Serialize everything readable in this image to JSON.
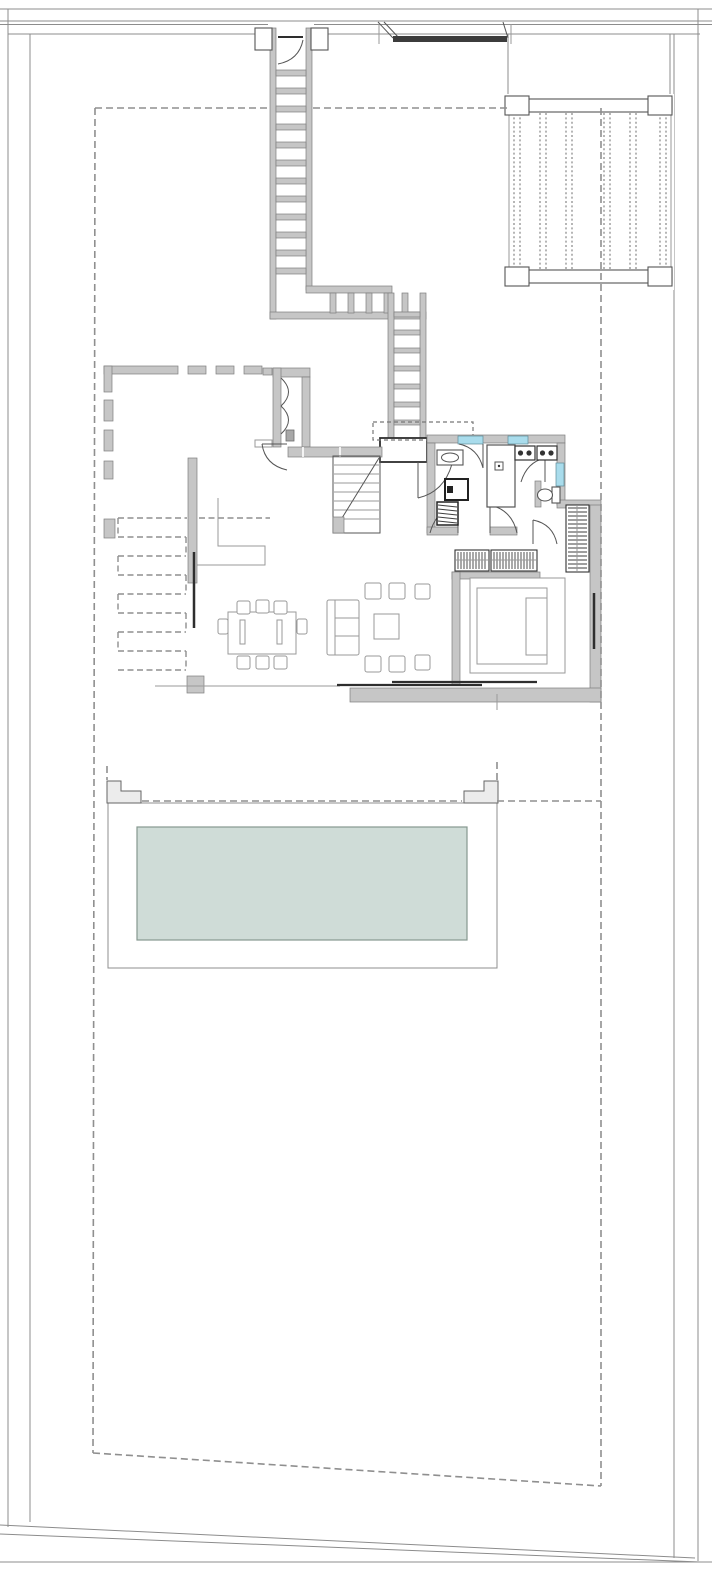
{
  "document": {
    "kind": "architectural-floor-plan",
    "description": "Ground-floor site plan of a detached villa: street-side entry stair, carport pergola, house core with kitchen and bathrooms, living-dining wing, bedroom suite, garden with serpentine exterior steps and a swimming-pool terrace inside a dashed setback boundary.",
    "visible_text": []
  },
  "colors": {
    "bg": "#ffffff",
    "wall_fill": "#c6c6c6",
    "wall_edge": "#7e7e7e",
    "line": "#555555",
    "thin": "#9a9a9a",
    "dark": "#2e2e2e",
    "dashed": "#8f8f8f",
    "window": "#a9dcec",
    "pool": "#cfdcd7",
    "pool_edge": "#86988f",
    "step": "#ececec"
  },
  "features": [
    {
      "name": "street-edge-lines",
      "desc": "double boundary lines along top street"
    },
    {
      "name": "entry-gate",
      "desc": "dark gate bar with splayed jambs on street line"
    },
    {
      "name": "property-boundary",
      "desc": "thin double lot lines left, right and sloped bottom"
    },
    {
      "name": "setback-dashed-boundary",
      "desc": "gray dashed buildable-area rectangle"
    },
    {
      "name": "entry-staircase",
      "desc": "long stepped corridor from street gate, L-turn, second flight to porch"
    },
    {
      "name": "carport-pergola",
      "desc": "slatted pergola with top and bottom beams, top right"
    },
    {
      "name": "garden-wall",
      "desc": "broken pier wall along upper-left court"
    },
    {
      "name": "vestibule",
      "desc": "entry court lobby with double-leaf arcs"
    },
    {
      "name": "front-porch",
      "desc": "dark-framed landing with canopy dashed outline"
    },
    {
      "name": "internal-staircase",
      "desc": "stair to upper floor with diagonal break line"
    },
    {
      "name": "powder-room",
      "desc": "sink, shower tray, boiler unit"
    },
    {
      "name": "shower-room",
      "desc": "walk-in shower with drain"
    },
    {
      "name": "vanity-cooktop-units",
      "desc": "two counter units with twin burners/basins"
    },
    {
      "name": "wc",
      "desc": "toilet with cistern in niche"
    },
    {
      "name": "windows",
      "desc": "three cyan window segments"
    },
    {
      "name": "bedroom",
      "desc": "double bed, side wardrobes with hanger hatch, sliding glass doors"
    },
    {
      "name": "living-room",
      "desc": "sofa, six poufs, coffee table"
    },
    {
      "name": "dining-table",
      "desc": "8-seat rectangular table"
    },
    {
      "name": "exterior-serpentine-steps",
      "desc": "dashed switchback garden steps with masonry piers"
    },
    {
      "name": "pool-terrace",
      "desc": "white deck with corner steps and rectangular pool"
    },
    {
      "name": "swimming-pool",
      "desc": "pale green-blue water rectangle"
    }
  ]
}
